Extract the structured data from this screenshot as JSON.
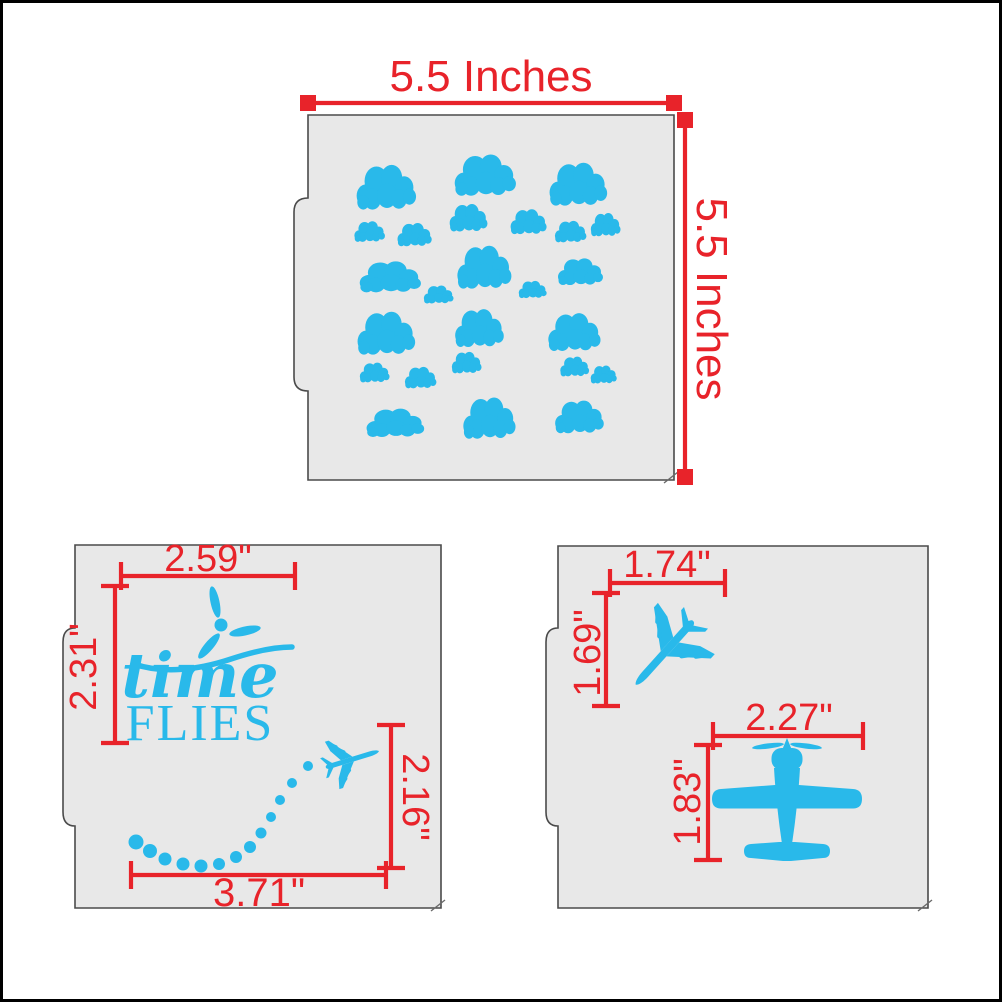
{
  "colors": {
    "accent_red": "#e8232a",
    "design_cyan": "#29b9ea",
    "stencil_fill": "#e8e8e8",
    "stencil_outline": "#4a4a4a",
    "frame": "#000000",
    "background": "#ffffff"
  },
  "dimensions": [
    {
      "id": "clouds-width",
      "label": "5.5 Inches",
      "x1": 305,
      "y1": 100,
      "x2": 671,
      "y2": 100,
      "ends": "square",
      "tx": 488,
      "ty": 88,
      "rot": 0,
      "fs": 44
    },
    {
      "id": "clouds-height",
      "label": "5.5 Inches",
      "x1": 682,
      "y1": 117,
      "x2": 682,
      "y2": 474,
      "ends": "square",
      "tx": 694,
      "ty": 296,
      "rot": 90,
      "fs": 44
    },
    {
      "id": "timeflies-top-width",
      "label": "2.59\"",
      "x1": 118,
      "y1": 573,
      "x2": 292,
      "y2": 573,
      "ends": "tick",
      "tx": 205,
      "ty": 568,
      "rot": 0,
      "fs": 38
    },
    {
      "id": "timeflies-left-height",
      "label": "2.31\"",
      "x1": 112,
      "y1": 583,
      "x2": 112,
      "y2": 740,
      "ends": "tick",
      "tx": 93,
      "ty": 664,
      "rot": -90,
      "fs": 38
    },
    {
      "id": "timeflies-right-height",
      "label": "2.16\"",
      "x1": 388,
      "y1": 722,
      "x2": 388,
      "y2": 865,
      "ends": "tick",
      "tx": 400,
      "ty": 794,
      "rot": 90,
      "fs": 38
    },
    {
      "id": "timeflies-bottom-width",
      "label": "3.71\"",
      "x1": 128,
      "y1": 872,
      "x2": 383,
      "y2": 872,
      "ends": "tick",
      "tx": 256,
      "ty": 903,
      "rot": 0,
      "fs": 40
    },
    {
      "id": "jet-width",
      "label": "1.74\"",
      "x1": 607,
      "y1": 580,
      "x2": 722,
      "y2": 580,
      "ends": "tick",
      "tx": 664,
      "ty": 574,
      "rot": 0,
      "fs": 38
    },
    {
      "id": "jet-height",
      "label": "1.69\"",
      "x1": 603,
      "y1": 590,
      "x2": 603,
      "y2": 703,
      "ends": "tick",
      "tx": 597,
      "ty": 650,
      "rot": -90,
      "fs": 38
    },
    {
      "id": "prop-width",
      "label": "2.27\"",
      "x1": 710,
      "y1": 733,
      "x2": 860,
      "y2": 733,
      "ends": "tick",
      "tx": 786,
      "ty": 727,
      "rot": 0,
      "fs": 38
    },
    {
      "id": "prop-height",
      "label": "1.83\"",
      "x1": 705,
      "y1": 742,
      "x2": 705,
      "y2": 857,
      "ends": "tick",
      "tx": 697,
      "ty": 799,
      "rot": -90,
      "fs": 38
    }
  ],
  "design": {
    "time_flies": {
      "script_word": "time",
      "caps_word": "FLIES"
    },
    "clouds": [
      [
        384,
        183,
        66,
        52
      ],
      [
        483,
        171,
        68,
        48
      ],
      [
        576,
        180,
        64,
        50
      ],
      [
        367,
        228,
        34,
        24
      ],
      [
        412,
        231,
        38,
        27
      ],
      [
        466,
        214,
        42,
        32
      ],
      [
        526,
        218,
        40,
        29
      ],
      [
        568,
        228,
        35,
        25
      ],
      [
        603,
        221,
        33,
        27
      ],
      [
        388,
        273,
        68,
        36
      ],
      [
        482,
        263,
        60,
        50
      ],
      [
        436,
        291,
        33,
        21
      ],
      [
        530,
        286,
        31,
        20
      ],
      [
        578,
        268,
        50,
        31
      ],
      [
        384,
        329,
        64,
        50
      ],
      [
        477,
        324,
        54,
        44
      ],
      [
        572,
        328,
        58,
        44
      ],
      [
        372,
        369,
        33,
        23
      ],
      [
        418,
        374,
        35,
        25
      ],
      [
        464,
        359,
        33,
        25
      ],
      [
        572,
        363,
        32,
        23
      ],
      [
        601,
        371,
        29,
        21
      ],
      [
        393,
        419,
        64,
        33
      ],
      [
        487,
        414,
        58,
        48
      ],
      [
        577,
        413,
        54,
        38
      ]
    ],
    "trail_dots": [
      [
        305,
        763,
        5
      ],
      [
        289,
        780,
        5
      ],
      [
        277,
        797,
        5
      ],
      [
        268,
        814,
        5
      ],
      [
        258,
        830,
        5.5
      ],
      [
        247,
        844,
        6
      ],
      [
        233,
        854,
        6
      ],
      [
        216,
        861,
        6
      ],
      [
        198,
        863,
        6.5
      ],
      [
        180,
        861,
        6.5
      ],
      [
        162,
        856,
        6.5
      ],
      [
        147,
        848,
        7
      ],
      [
        133,
        839,
        7.5
      ]
    ]
  }
}
